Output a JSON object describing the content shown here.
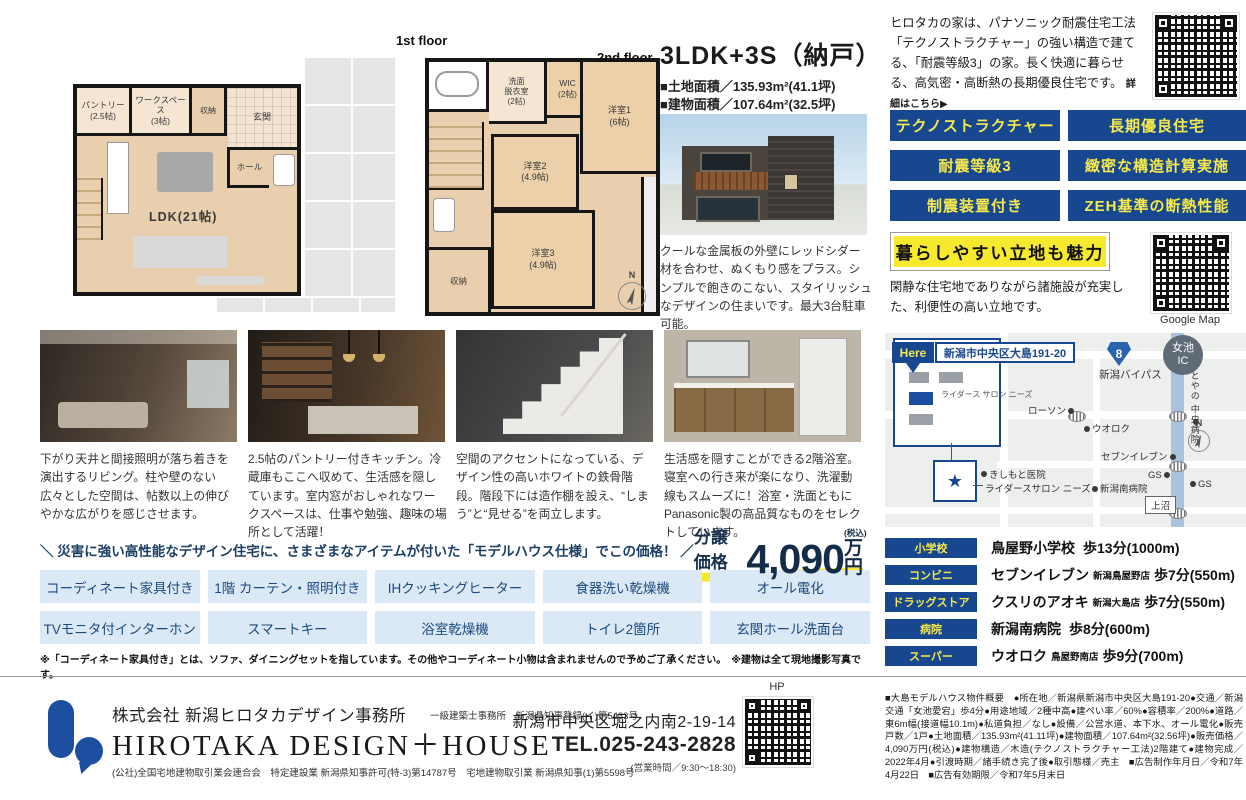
{
  "accent": {
    "navy": "#17478e",
    "yellow": "#f6e82e",
    "light_blue": "#dbe8f6"
  },
  "plans": {
    "first_label": "1st floor",
    "second_label": "2nd floor",
    "compass_n": "N",
    "p1": {
      "pantry": "パントリー\n(2.5帖)",
      "workspace": "ワークスペース\n(3帖)",
      "storage": "収納",
      "entrance": "玄関",
      "hall": "ホール",
      "ldk": "LDK(21帖)"
    },
    "p2": {
      "washroom": "洗面\n脱衣室\n(2帖)",
      "wic": "WIC\n(2帖)",
      "room1": "洋室1\n(6帖)",
      "room2": "洋室2\n(4.9帖)",
      "room3": "洋室3\n(4.9帖)",
      "storage": "収納"
    }
  },
  "summary": {
    "title": "3LDK+3S（納戸）",
    "land_area": "■土地面積／135.93m²(41.1坪)",
    "building_area": "■建物面積／107.64m²(32.5坪)",
    "exterior_caption": "クールな金属板の外壁にレッドシダー材を合わせ、ぬくもり感をプラス。シンプルで飽きのこない、スタイリッシュなデザインの住まいです。最大3台駐車可能。"
  },
  "intro": {
    "text": "ヒロタカの家は、パナソニック耐震住宅工法「テクノストラクチャー」の強い構造で建てる、「耐震等級3」の家。長く快適に暮らせる、高気密・高断熱の長期優良住宅です。",
    "link": "詳細はこちら▶"
  },
  "badges": [
    "テクノストラクチャー",
    "長期優良住宅",
    "耐震等級3",
    "緻密な構造計算実施",
    "制震装置付き",
    "ZEH基準の断熱性能"
  ],
  "location": {
    "banner": "暮らしやすい立地も魅力",
    "desc": "閑静な住宅地でありながら諸施設が充実した、利便性の高い立地です。",
    "qr_caption": "Google Map"
  },
  "map": {
    "here": "Here",
    "address": "新潟市中央区大島191-20",
    "inset_building": "ライダース\nサロン\nニーズ",
    "star": "★",
    "route_number": "8",
    "bypass": "新潟バイパス",
    "ic": "女池\nIC",
    "hospital_side": "とやの\n中央病院",
    "lawson": "ローソン",
    "uoroku": "ウオロク",
    "seven": "セブンイレブン",
    "clinic": "きしもと医院",
    "riders": "ライダースサロン ニーズ",
    "south_hospital": "新潟南病院",
    "gs1": "GS",
    "gs2": "GS",
    "kaminuma": "上沼",
    "compass_n": "N"
  },
  "facilities": [
    {
      "label": "小学校",
      "name": "鳥屋野小学校",
      "sub": "",
      "walk": "歩13分(1000m)"
    },
    {
      "label": "コンビニ",
      "name": "セブンイレブン",
      "sub": "新潟鳥屋野店",
      "walk": "歩7分(550m)"
    },
    {
      "label": "ドラッグストア",
      "name": "クスリのアオキ",
      "sub": "新潟大島店",
      "walk": "歩7分(550m)"
    },
    {
      "label": "病院",
      "name": "新潟南病院",
      "sub": "",
      "walk": "歩8分(600m)"
    },
    {
      "label": "スーパー",
      "name": "ウオロク",
      "sub": "鳥屋野南店",
      "walk": "歩9分(700m)"
    }
  ],
  "price": {
    "lead": "＼ 災害に強い高性能なデザイン住宅に、さまざまなアイテムが付いた「モデルハウス仕様」でこの価格！ ／",
    "label": "分譲価格",
    "value": "4,090",
    "unit": "万円",
    "tax": "(税込)"
  },
  "features1": [
    "コーディネート家具付き",
    "1階 カーテン・照明付き",
    "IHクッキングヒーター",
    "食器洗い乾燥機",
    "オール電化"
  ],
  "features2": [
    "TVモニタ付インターホン",
    "スマートキー",
    "浴室乾燥機",
    "トイレ2箇所",
    "玄関ホール洗面台"
  ],
  "notes": {
    "features_note": "※「コーディネート家具付き」とは、ソファ、ダイニングセットを指しています。その他やコーディネート小物は含まれませんので予めご了承ください。　※建物は全て現地撮影写真です。"
  },
  "captions": [
    "下がり天井と間接照明が落ち着きを演出するリビング。柱や壁のない広々とした空間は、帖数以上の伸びやかな広がりを感じさせます。",
    "2.5帖のパントリー付きキッチン。冷蔵庫もここへ収めて、生活感を隠しています。室内窓がおしゃれなワークスペースは、仕事や勉強、趣味の場所として活躍！",
    "空間のアクセントになっている、デザイン性の高いホワイトの鉄骨階段。階段下には造作棚を設え、“しまう”と“見せる”を両立します。",
    "生活感を隠すことができる2階浴室。寝室への行き来が楽になり、洗濯動線もスムーズに！浴室・洗面ともにPanasonic製の高品質なものをセレクトしています。"
  ],
  "footer": {
    "hp_label": "HP",
    "company_jp": "株式会社 新潟ヒロタカデザイン事務所",
    "license1": "一級建築士事務所　新潟県知事登録(イ)第5433号",
    "company_en": "HIROTAKA DESIGN＋HOUSE",
    "license2": "(公社)全国宅地建物取引業会連合会　特定建設業 新潟県知事許可(特-3)第14787号　宅地建物取引業 新潟県知事(1)第5598号",
    "address": "新潟市中央区堀之内南2-19-14",
    "tel": "TEL.025-243-2828",
    "hours": "(営業時間／9:30～18:30)",
    "property_details": "■大島モデルハウス物件概要　●所在地／新潟県新潟市中央区大島191-20●交通／新潟交通「女池愛宕」歩4分●用途地域／2種中高●建ぺい率／60%●容積率／200%●道路／東6m幅(接道幅10.1m)●私道負担／なし●設備／公営水道、本下水、オール電化●販売戸数／1戸●土地面積／135.93m²(41.11坪)●建物面積／107.64m²(32.56坪)●販売価格／4,090万円(税込)●建物構造／木造(テクノストラクチャー工法)2階建て●建物完成／2022年4月●引渡時期／諸手続き完了後●取引態様／売主　■広告制作年月日／令和7年4月22日　■広告有効期限／令和7年5月末日"
  }
}
